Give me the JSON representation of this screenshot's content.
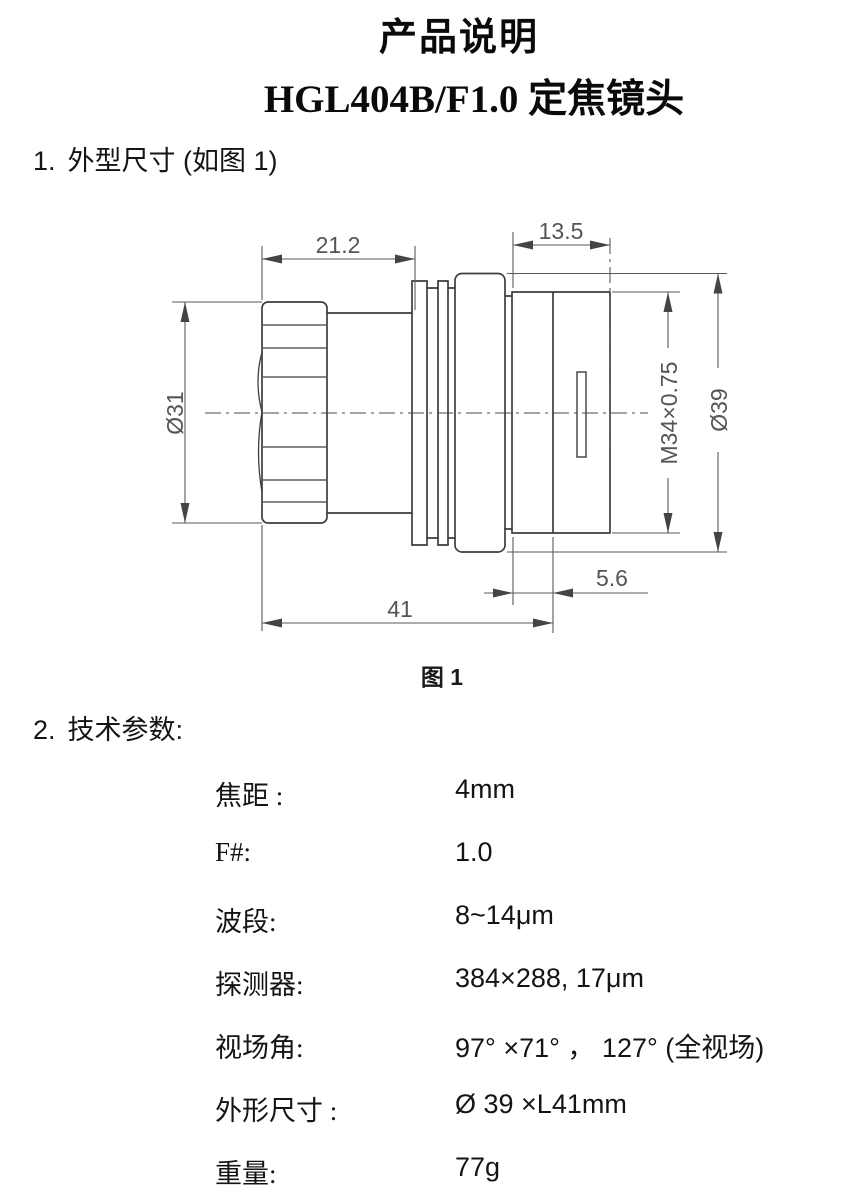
{
  "header": {
    "title": "产品说明",
    "subtitle": "HGL404B/F1.0 定焦镜头"
  },
  "sections": [
    {
      "number": "1.",
      "label": "外型尺寸 (如图 1)"
    },
    {
      "number": "2.",
      "label": "技术参数:"
    }
  ],
  "figure": {
    "caption": "图 1",
    "dimensions": {
      "front_length": "21.2",
      "rear_mount_length": "13.5",
      "front_diameter": "Ø31",
      "thread_spec": "M34×0.75",
      "outer_diameter": "Ø39",
      "flange_width": "5.6",
      "body_length": "41"
    }
  },
  "parameters": {
    "rows": [
      {
        "label": "焦距 :",
        "value": "4mm"
      },
      {
        "label": "F#:",
        "value": "1.0"
      },
      {
        "label": "波段:",
        "value": "8~14μm"
      },
      {
        "label": "探测器:",
        "value": "384×288, 17μm"
      },
      {
        "label": "视场角:",
        "value": "97° ×71° ， 127° (全视场)"
      },
      {
        "label": "外形尺寸 :",
        "value": "Ø 39 ×L41mm"
      },
      {
        "label": "重量:",
        "value": "77g"
      }
    ]
  }
}
